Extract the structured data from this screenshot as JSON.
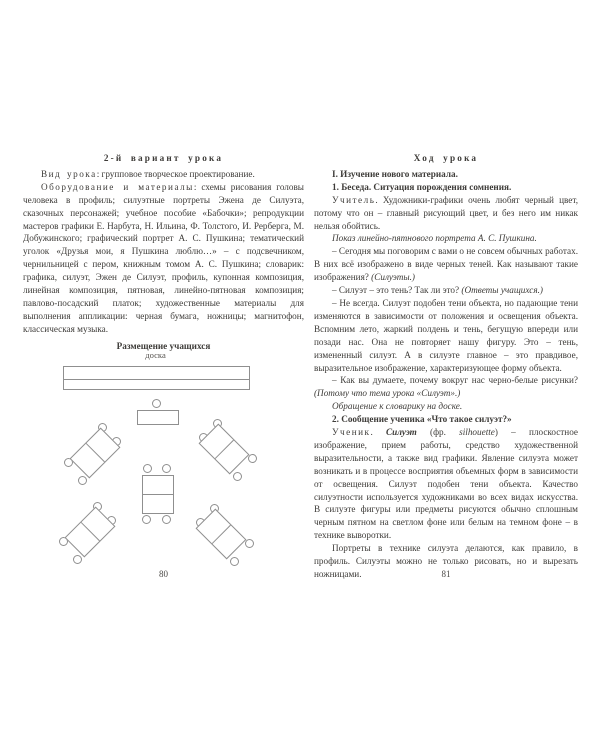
{
  "colors": {
    "background": "#ffffff",
    "text": "#3e3c39",
    "diagram_line": "#8f8f8f"
  },
  "left_page": {
    "page_number": "80",
    "diagram": {
      "board_label": "доска"
    },
    "paragraphs": [
      {
        "type": "title",
        "runs": [
          {
            "t": "2-й вариант урока",
            "s": ""
          }
        ]
      },
      {
        "type": "body",
        "runs": [
          {
            "t": "Вид урока",
            "s": "sp"
          },
          {
            "t": ": групповое творческое проектирование.",
            "s": ""
          }
        ]
      },
      {
        "type": "body",
        "runs": [
          {
            "t": "Оборудование и материалы",
            "s": "sp"
          },
          {
            "t": ": схемы рисования головы человека в профиль; силуэтные портреты Эжена де Силуэта, сказочных персонажей; учебное пособие «Бабочки»; репродукции мастеров графики Е. Нарбута, Н. Ильина, Ф. Толстого, И. Рерберга, М. Добужинского; графический портрет А. С. Пушкина; тематический уголок «Друзья мои, я Пушкина люблю…» – с подсвечником, чернильницей с пером, книжным томом А. С. Пушкина; словарик: графика, силуэт, Эжен де Силуэт, профиль, купонная композиция, линейная композиция, пятновая, линейно-пятновая композиция; павлово-посадский платок; художественные материалы для выполнения аппликации: черная бумага, ножницы; магнитофон, классическая музыка.",
            "s": ""
          }
        ]
      },
      {
        "type": "heading",
        "runs": [
          {
            "t": "Размещение учащихся",
            "s": ""
          }
        ]
      }
    ]
  },
  "right_page": {
    "page_number": "81",
    "paragraphs": [
      {
        "type": "title",
        "runs": [
          {
            "t": "Ход урока",
            "s": ""
          }
        ]
      },
      {
        "type": "body",
        "runs": [
          {
            "t": "I. Изучение нового материала.",
            "s": "b"
          }
        ]
      },
      {
        "type": "body",
        "runs": [
          {
            "t": "1. Беседа. Ситуация порождения сомнения.",
            "s": "b"
          }
        ]
      },
      {
        "type": "body",
        "runs": [
          {
            "t": "Учитель",
            "s": "sp"
          },
          {
            "t": ". Художники-графики очень любят черный цвет, потому что он – главный рисующий цвет, и без него им никак нельзя обойтись.",
            "s": ""
          }
        ]
      },
      {
        "type": "body",
        "runs": [
          {
            "t": "Показ линейно-пятнового портрета А. С. Пушкина.",
            "s": "i"
          }
        ]
      },
      {
        "type": "body",
        "runs": [
          {
            "t": "– Сегодня мы поговорим с вами о не совсем обычных работах. В них всё изображено в виде черных теней. Как называют такие изображения? ",
            "s": ""
          },
          {
            "t": "(Силуэты.)",
            "s": "i"
          }
        ]
      },
      {
        "type": "body",
        "runs": [
          {
            "t": "– Силуэт – это тень? Так ли это? ",
            "s": ""
          },
          {
            "t": "(Ответы учащихся.)",
            "s": "i"
          }
        ]
      },
      {
        "type": "body",
        "runs": [
          {
            "t": "– Не всегда. Силуэт подобен тени объекта, но падающие тени изменяются в зависимости от положения и освещения объекта. Вспомним лето, жаркий полдень и тень, бегущую впереди или позади нас. Она не повторяет нашу фигуру. Это – тень, измененный силуэт. А в силуэте главное – это правдивое, выразительное изображение, характеризующее форму объекта.",
            "s": ""
          }
        ]
      },
      {
        "type": "body",
        "runs": [
          {
            "t": "– Как вы думаете, почему вокруг нас черно-белые рисунки? ",
            "s": ""
          },
          {
            "t": "(Потому что тема урока «Силуэт».)",
            "s": "i"
          }
        ]
      },
      {
        "type": "body",
        "runs": [
          {
            "t": "Обращение к словарику на доске.",
            "s": "i"
          }
        ]
      },
      {
        "type": "body",
        "runs": [
          {
            "t": "2. Сообщение ученика «Что такое силуэт?»",
            "s": "b"
          }
        ]
      },
      {
        "type": "body",
        "runs": [
          {
            "t": "Ученик",
            "s": "sp"
          },
          {
            "t": ". ",
            "s": ""
          },
          {
            "t": "Силуэт",
            "s": "bi"
          },
          {
            "t": " (фр. ",
            "s": ""
          },
          {
            "t": "silhouette",
            "s": "i"
          },
          {
            "t": ") – плоскостное изображение, прием работы, средство художественной выразительности, а также вид графики. Явление силуэта может возникать и в процессе восприятия объемных форм в зависимости от освещения. Силуэт подобен тени объекта. Качество силуэтности используется художниками во всех видах искусства. В силуэте фигуры или предметы рисуются обычно сплошным черным пятном на светлом фоне или белым на темном фоне – в технике выворотки.",
            "s": ""
          }
        ]
      },
      {
        "type": "body",
        "runs": [
          {
            "t": "Портреты в технике силуэта делаются, как правило, в профиль. Силуэты можно не только рисовать, но и вырезать ножницами.",
            "s": ""
          }
        ]
      }
    ]
  }
}
